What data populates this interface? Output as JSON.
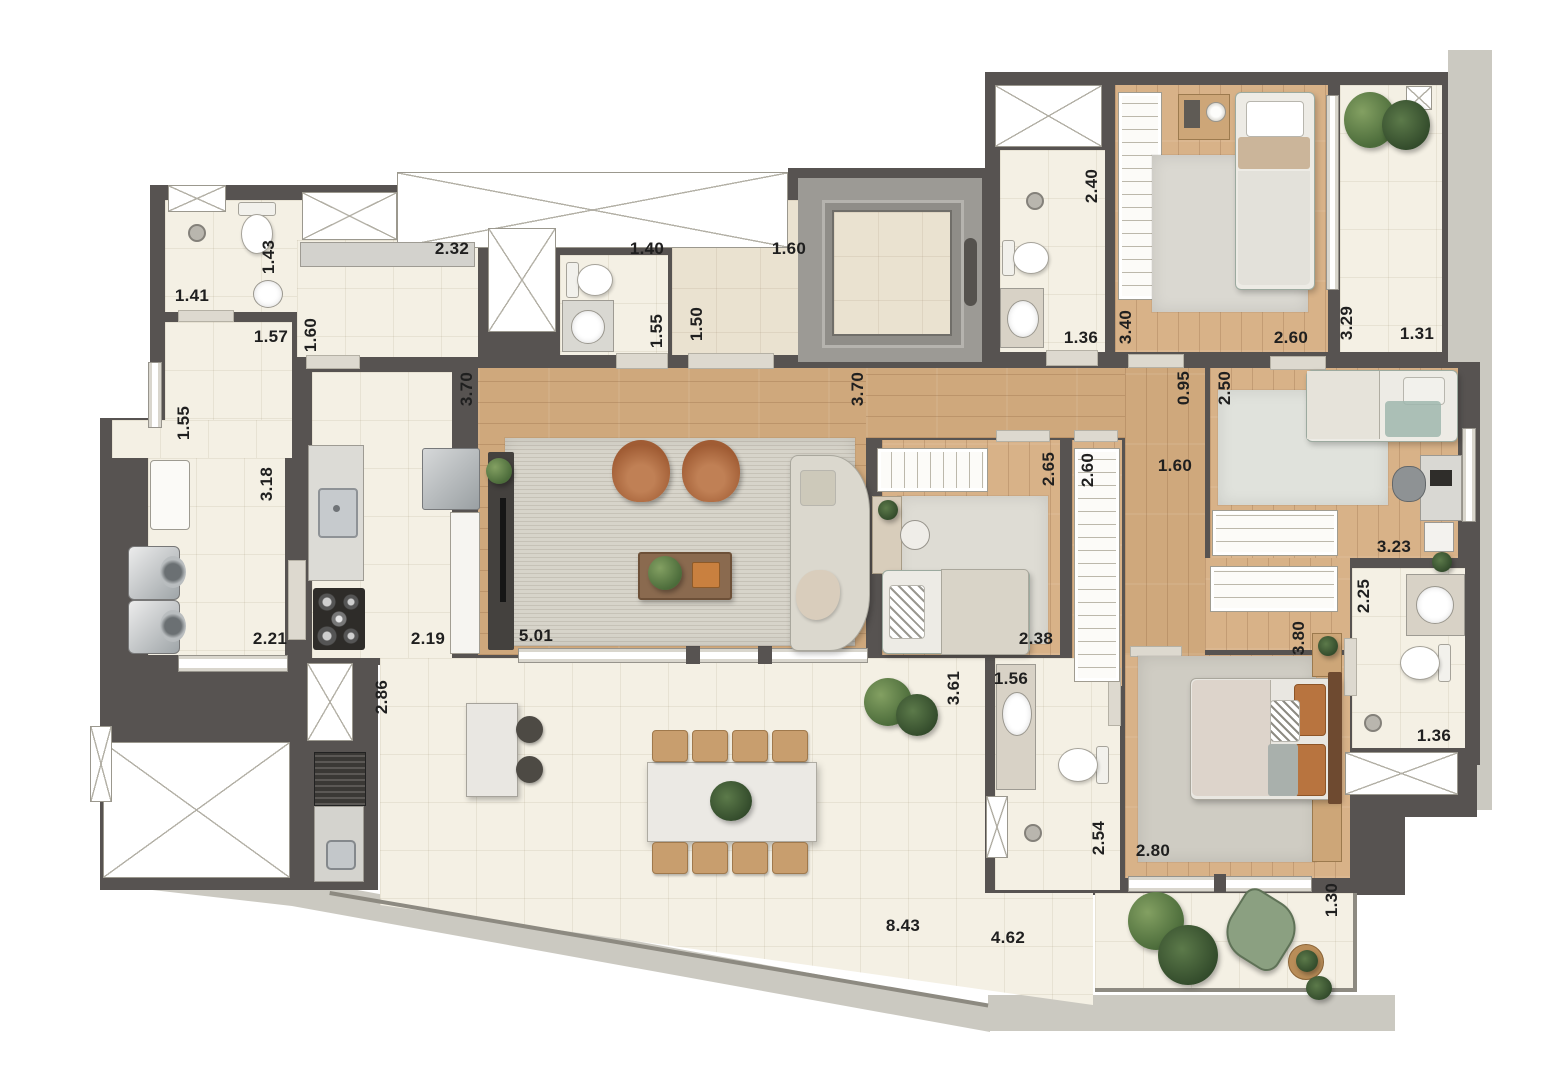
{
  "document": {
    "type_note": "apartment floor plan rendering, dimensions in meters"
  },
  "colors": {
    "wall": "#575351",
    "floor_cream": "#f4f0e4",
    "wood": "#cfa87c",
    "rug": "#d7d4ca",
    "terrace_apron": "#cbc9c1",
    "rail": "#8d8a81",
    "granite": "#d9d8d2",
    "elevator_gray": "#9c9a95",
    "accent_armchair": "#ad6a42",
    "accent_teal": "#9fb7ae",
    "plant_green": "#4b6b3a",
    "balcony_chair_green": "#8ba081"
  },
  "icons": {
    "shaft": "crossed-box",
    "toilet": "toilet-icon",
    "sink": "sink-icon",
    "shower": "shower-icon",
    "stove": "cooktop-icon",
    "washer": "washer-icon",
    "grill": "grill-icon",
    "plant": "plant-icon",
    "elevator": "elevator-icon"
  },
  "dimension_labels": [
    {
      "text": "1.41",
      "x": 192,
      "y": 296,
      "v": false
    },
    {
      "text": "1.43",
      "x": 269,
      "y": 257,
      "v": true
    },
    {
      "text": "1.57",
      "x": 271,
      "y": 337,
      "v": false
    },
    {
      "text": "1.60",
      "x": 311,
      "y": 335,
      "v": true
    },
    {
      "text": "2.32",
      "x": 452,
      "y": 249,
      "v": false
    },
    {
      "text": "1.40",
      "x": 647,
      "y": 249,
      "v": false
    },
    {
      "text": "1.55",
      "x": 657,
      "y": 331,
      "v": true
    },
    {
      "text": "1.50",
      "x": 697,
      "y": 324,
      "v": true
    },
    {
      "text": "1.60",
      "x": 789,
      "y": 249,
      "v": false
    },
    {
      "text": "1.36",
      "x": 1081,
      "y": 338,
      "v": false
    },
    {
      "text": "2.40",
      "x": 1092,
      "y": 186,
      "v": true
    },
    {
      "text": "3.40",
      "x": 1126,
      "y": 327,
      "v": true
    },
    {
      "text": "2.60",
      "x": 1291,
      "y": 338,
      "v": false
    },
    {
      "text": "3.29",
      "x": 1347,
      "y": 323,
      "v": true
    },
    {
      "text": "1.31",
      "x": 1417,
      "y": 334,
      "v": false
    },
    {
      "text": "1.55",
      "x": 184,
      "y": 423,
      "v": true
    },
    {
      "text": "3.70",
      "x": 467,
      "y": 389,
      "v": true
    },
    {
      "text": "3.70",
      "x": 858,
      "y": 389,
      "v": true
    },
    {
      "text": "0.95",
      "x": 1184,
      "y": 388,
      "v": true
    },
    {
      "text": "2.50",
      "x": 1225,
      "y": 388,
      "v": true
    },
    {
      "text": "1.60",
      "x": 1175,
      "y": 466,
      "v": false
    },
    {
      "text": "3.18",
      "x": 267,
      "y": 484,
      "v": true
    },
    {
      "text": "2.65",
      "x": 1049,
      "y": 469,
      "v": true
    },
    {
      "text": "2.60",
      "x": 1088,
      "y": 470,
      "v": true
    },
    {
      "text": "3.23",
      "x": 1394,
      "y": 547,
      "v": false
    },
    {
      "text": "2.25",
      "x": 1364,
      "y": 596,
      "v": true
    },
    {
      "text": "2.21",
      "x": 270,
      "y": 639,
      "v": false
    },
    {
      "text": "2.19",
      "x": 428,
      "y": 639,
      "v": false
    },
    {
      "text": "5.01",
      "x": 536,
      "y": 636,
      "v": false
    },
    {
      "text": "2.38",
      "x": 1036,
      "y": 639,
      "v": false
    },
    {
      "text": "3.80",
      "x": 1299,
      "y": 638,
      "v": true
    },
    {
      "text": "2.86",
      "x": 382,
      "y": 697,
      "v": true
    },
    {
      "text": "3.61",
      "x": 954,
      "y": 688,
      "v": true
    },
    {
      "text": "1.56",
      "x": 1011,
      "y": 679,
      "v": false
    },
    {
      "text": "2.54",
      "x": 1099,
      "y": 838,
      "v": true
    },
    {
      "text": "2.80",
      "x": 1153,
      "y": 851,
      "v": false
    },
    {
      "text": "1.36",
      "x": 1434,
      "y": 736,
      "v": false
    },
    {
      "text": "1.30",
      "x": 1332,
      "y": 900,
      "v": true
    },
    {
      "text": "8.43",
      "x": 903,
      "y": 926,
      "v": false
    },
    {
      "text": "4.62",
      "x": 1008,
      "y": 938,
      "v": false
    }
  ]
}
